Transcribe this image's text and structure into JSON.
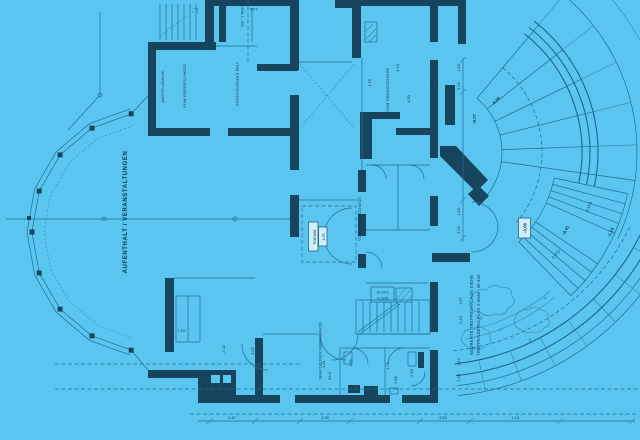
{
  "colors": {
    "background": "#5ac6f0",
    "wall": "#17455e",
    "line": "#1b6390",
    "line_light": "#2e81aa",
    "text": "#0c3750",
    "label_box_fill": "#cdeefb"
  },
  "rooms": [
    {
      "label": "AUFENTHALT / VERANSTALTUNGEN"
    },
    {
      "label": "VOM ERDGESCHOSS"
    },
    {
      "label": "VOM 1. OG"
    },
    {
      "label": "VOM ERDGESCHOSS"
    },
    {
      "label": "VOM ERDGESCHOSS"
    },
    {
      "label": "ABSTELLRAUM"
    },
    {
      "label": "VOM ERDGESCHOSS"
    },
    {
      "label": "KÜCHE"
    },
    {
      "label": "SCHWIMMBECKENTECHNIK"
    },
    {
      "label": "PODIUM"
    },
    {
      "label": "1.05"
    }
  ],
  "notes": [
    "GEDREHTE TREPPENANLAGE SIEHE",
    "TREPPENDETAILPLAN 2.5648 · BI-448"
  ],
  "elevations": [
    "-3.06",
    "-0.41",
    "-1.13",
    "-0.77",
    "-0.05"
  ],
  "stairs": {
    "flight_a": "8 STG",
    "flight_b": "8 STG",
    "box_line_1": "16 STG",
    "box_line_2": "17,5/28"
  },
  "dimensions": [
    "7.10",
    "2.02",
    "4.95",
    "1.91",
    "62.5",
    "1.39",
    "1.79",
    "2.10",
    "3.88",
    "1.78",
    "4.19",
    "4.50",
    "4.13",
    "1.10",
    "3.28",
    "1.10",
    "3.28",
    "1.67",
    "2.16",
    "1.12",
    "2.10",
    "1.26",
    "3.47",
    "2.26",
    "4.50",
    "1.13"
  ]
}
